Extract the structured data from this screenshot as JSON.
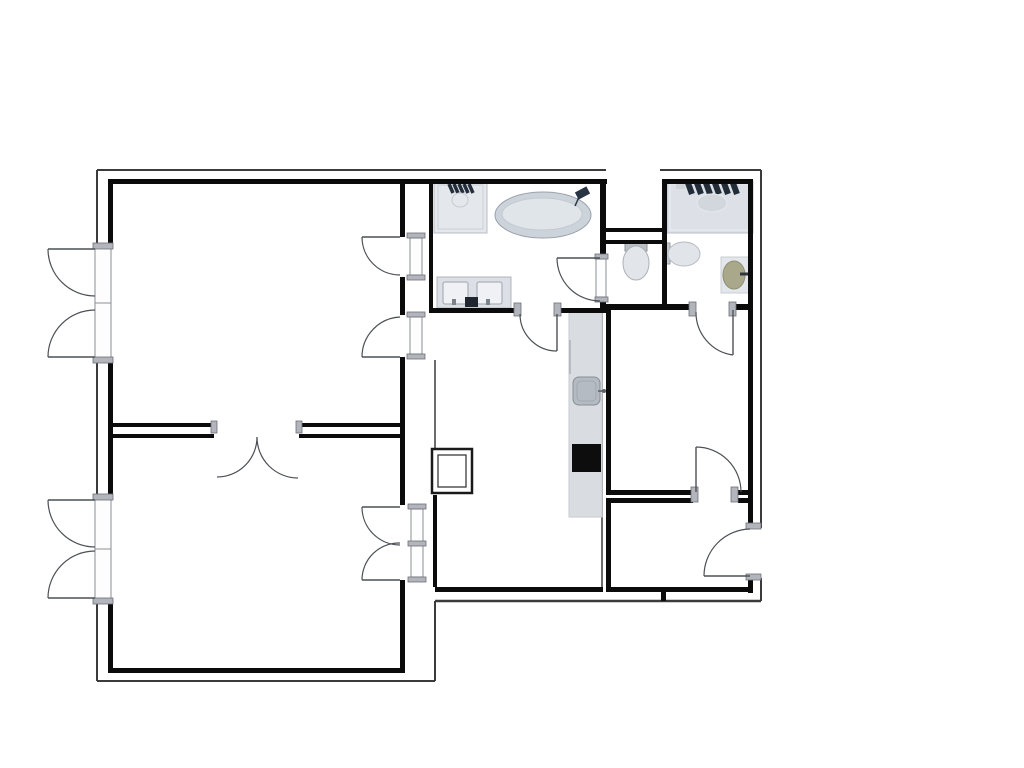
{
  "canvas": {
    "w": 1024,
    "h": 768,
    "bg": "#ffffff"
  },
  "palette": {
    "wall": "#0b0b0b",
    "outline": "#3b3b3c",
    "swing": "#4d5055",
    "cap_fill": "#b2b6bc",
    "cap_stroke": "#6b6f75",
    "frame_fill": "#fdfdfd",
    "frame_stroke": "#8a8f96",
    "fixture_light": "#dde1e7",
    "fixture_mid": "#b5bbc2",
    "fixture_dark": "#222b38",
    "basin_olive": "#aaa88b",
    "cooktop_black": "#0d0d0d"
  },
  "walls_thick": [
    {
      "n": "wall-top-left-room",
      "r": [
        108,
        179,
        297,
        5
      ]
    },
    {
      "n": "wall-top-center",
      "r": [
        404,
        179,
        203,
        5
      ]
    },
    {
      "n": "wall-top-right-room",
      "r": [
        662,
        179,
        91,
        5
      ]
    },
    {
      "n": "wall-left-upper",
      "r": [
        108,
        179,
        5,
        67
      ]
    },
    {
      "n": "wall-left-middle",
      "r": [
        108,
        360,
        5,
        137
      ]
    },
    {
      "n": "wall-left-lower",
      "r": [
        108,
        601,
        5,
        72
      ]
    },
    {
      "n": "wall-rooms-right-1",
      "r": [
        400,
        179,
        5,
        58
      ]
    },
    {
      "n": "wall-rooms-right-2",
      "r": [
        400,
        277,
        5,
        38
      ]
    },
    {
      "n": "wall-rooms-right-3",
      "r": [
        400,
        357,
        5,
        148
      ]
    },
    {
      "n": "wall-rooms-right-4",
      "r": [
        400,
        580,
        5,
        93
      ]
    },
    {
      "n": "wall-divider-top-a",
      "r": [
        108,
        423,
        106,
        4
      ]
    },
    {
      "n": "wall-divider-top-b",
      "r": [
        299,
        423,
        104,
        4
      ]
    },
    {
      "n": "wall-divider-bot-a",
      "r": [
        108,
        434,
        106,
        4
      ]
    },
    {
      "n": "wall-divider-bot-b",
      "r": [
        299,
        434,
        104,
        4
      ]
    },
    {
      "n": "wall-bottom-left-room",
      "r": [
        108,
        668,
        297,
        5
      ]
    },
    {
      "n": "wall-bathroom-left",
      "r": [
        429,
        179,
        4,
        134
      ]
    },
    {
      "n": "wall-bathroom-bottom-a",
      "r": [
        429,
        308,
        90,
        5
      ]
    },
    {
      "n": "wall-bathroom-bottom-b",
      "r": [
        557,
        308,
        50,
        5
      ]
    },
    {
      "n": "wall-bathroom-right-a",
      "r": [
        600,
        179,
        6,
        81
      ]
    },
    {
      "n": "wall-bathroom-right-b",
      "r": [
        600,
        298,
        6,
        15
      ]
    },
    {
      "n": "wall-lightwell-bottom",
      "r": [
        604,
        228,
        60,
        4
      ]
    },
    {
      "n": "wall-wc-top",
      "r": [
        604,
        240,
        60,
        4
      ]
    },
    {
      "n": "wall-wc-right",
      "r": [
        662,
        179,
        5,
        131
      ]
    },
    {
      "n": "wall-bedroom-top-a",
      "r": [
        604,
        304,
        92,
        6
      ]
    },
    {
      "n": "wall-bedroom-top-b",
      "r": [
        732,
        304,
        21,
        6
      ]
    },
    {
      "n": "wall-bedroom-left",
      "r": [
        606,
        310,
        5,
        185
      ]
    },
    {
      "n": "wall-entry-left",
      "r": [
        606,
        503,
        5,
        89
      ]
    },
    {
      "n": "wall-right-upper",
      "r": [
        748,
        179,
        5,
        349
      ]
    },
    {
      "n": "wall-right-lower",
      "r": [
        748,
        578,
        5,
        15
      ]
    },
    {
      "n": "wall-bedroom-bottom-a",
      "r": [
        606,
        490,
        87,
        5
      ]
    },
    {
      "n": "wall-bedroom-bottom-b",
      "r": [
        738,
        490,
        15,
        5
      ]
    },
    {
      "n": "wall-entry-top-a",
      "r": [
        606,
        498,
        87,
        5
      ]
    },
    {
      "n": "wall-entry-top-b",
      "r": [
        738,
        498,
        15,
        5
      ]
    },
    {
      "n": "wall-dining-bottom",
      "r": [
        435,
        587,
        168,
        5
      ]
    },
    {
      "n": "wall-entry-bottom",
      "r": [
        606,
        587,
        147,
        5
      ]
    },
    {
      "n": "wall-stub",
      "r": [
        661,
        592,
        5,
        9
      ]
    },
    {
      "n": "wall-dining-left",
      "r": [
        433,
        495,
        4,
        92
      ]
    }
  ],
  "walls_thin": [
    {
      "n": "outline-top-a",
      "l": [
        97,
        170,
        606,
        170
      ],
      "w": 2
    },
    {
      "n": "outline-top-b",
      "l": [
        660,
        170,
        761,
        170
      ],
      "w": 2
    },
    {
      "n": "outline-right-a",
      "l": [
        761,
        170,
        761,
        528
      ],
      "w": 2
    },
    {
      "n": "outline-right-b",
      "l": [
        761,
        578,
        761,
        601
      ],
      "w": 2
    },
    {
      "n": "outline-bottom-right",
      "l": [
        761,
        601,
        435,
        601
      ],
      "w": 2.5
    },
    {
      "n": "outline-step",
      "l": [
        435,
        601,
        435,
        681
      ],
      "w": 2
    },
    {
      "n": "outline-bottom-left",
      "l": [
        435,
        681,
        97,
        681
      ],
      "w": 2
    },
    {
      "n": "outline-left-a",
      "l": [
        97,
        681,
        97,
        601
      ],
      "w": 2
    },
    {
      "n": "outline-left-b",
      "l": [
        97,
        497,
        97,
        360
      ],
      "w": 2
    },
    {
      "n": "outline-left-c",
      "l": [
        97,
        246,
        97,
        170
      ],
      "w": 2
    },
    {
      "n": "wall-kitchen-right",
      "l": [
        602,
        311,
        602,
        590
      ],
      "w": 1.5
    },
    {
      "n": "wall-dining-offset",
      "l": [
        435,
        360,
        435,
        449
      ],
      "w": 1.5
    }
  ],
  "window_frames": [
    {
      "n": "window-frame-upper",
      "r": [
        95,
        246,
        16,
        114
      ],
      "mull": [
        95,
        303,
        111,
        303
      ]
    },
    {
      "n": "window-frame-lower",
      "r": [
        95,
        497,
        16,
        104
      ],
      "mull": [
        95,
        549,
        111,
        549
      ]
    }
  ],
  "door_frames": [
    {
      "n": "door-frame",
      "r": [
        410,
        238,
        12,
        37
      ]
    },
    {
      "n": "door-frame",
      "r": [
        410,
        317,
        12,
        37
      ]
    },
    {
      "n": "door-frame",
      "r": [
        411,
        509,
        12,
        68
      ]
    },
    {
      "n": "door-frame",
      "r": [
        596,
        259,
        10,
        38
      ]
    }
  ],
  "door_caps": [
    {
      "n": "door-jamb-cap",
      "r": [
        407,
        233,
        18,
        5
      ]
    },
    {
      "n": "door-jamb-cap",
      "r": [
        407,
        275,
        18,
        5
      ]
    },
    {
      "n": "door-jamb-cap",
      "r": [
        407,
        312,
        18,
        5
      ]
    },
    {
      "n": "door-jamb-cap",
      "r": [
        407,
        354,
        18,
        5
      ]
    },
    {
      "n": "door-jamb-cap",
      "r": [
        408,
        504,
        18,
        5
      ]
    },
    {
      "n": "door-jamb-cap",
      "r": [
        408,
        541,
        18,
        5
      ]
    },
    {
      "n": "door-jamb-cap",
      "r": [
        408,
        577,
        18,
        5
      ]
    },
    {
      "n": "door-jamb-cap",
      "r": [
        211,
        421,
        6,
        12
      ]
    },
    {
      "n": "door-jamb-cap",
      "r": [
        296,
        421,
        6,
        12
      ]
    },
    {
      "n": "door-jamb-cap",
      "r": [
        514,
        303,
        7,
        13
      ]
    },
    {
      "n": "door-jamb-cap",
      "r": [
        554,
        303,
        7,
        13
      ]
    },
    {
      "n": "door-jamb-cap",
      "r": [
        595,
        254,
        13,
        5
      ]
    },
    {
      "n": "door-jamb-cap",
      "r": [
        595,
        297,
        13,
        5
      ]
    },
    {
      "n": "door-jamb-cap",
      "r": [
        689,
        302,
        7,
        14
      ]
    },
    {
      "n": "door-jamb-cap",
      "r": [
        729,
        302,
        7,
        14
      ]
    },
    {
      "n": "door-jamb-cap",
      "r": [
        691,
        487,
        7,
        15
      ]
    },
    {
      "n": "door-jamb-cap",
      "r": [
        731,
        487,
        7,
        15
      ]
    },
    {
      "n": "door-jamb-cap",
      "r": [
        746,
        523,
        15,
        6
      ]
    },
    {
      "n": "door-jamb-cap",
      "r": [
        746,
        574,
        15,
        6
      ]
    },
    {
      "n": "window-jamb-cap",
      "r": [
        93,
        243,
        20,
        6
      ]
    },
    {
      "n": "window-jamb-cap",
      "r": [
        93,
        357,
        20,
        6
      ]
    },
    {
      "n": "window-jamb-cap",
      "r": [
        93,
        494,
        20,
        6
      ]
    },
    {
      "n": "window-jamb-cap",
      "r": [
        93,
        598,
        20,
        6
      ]
    }
  ],
  "door_leaves": [
    {
      "n": "door-leaf",
      "l": [
        362,
        237,
        400,
        237
      ]
    },
    {
      "n": "door-leaf",
      "l": [
        362,
        357,
        400,
        357
      ]
    },
    {
      "n": "door-leaf",
      "l": [
        362,
        507,
        400,
        507
      ]
    },
    {
      "n": "door-leaf",
      "l": [
        362,
        580,
        400,
        580
      ]
    },
    {
      "n": "window-casement-leaf",
      "l": [
        48,
        249,
        95,
        249
      ]
    },
    {
      "n": "window-casement-leaf",
      "l": [
        48,
        357,
        95,
        357
      ]
    },
    {
      "n": "window-casement-leaf",
      "l": [
        48,
        500,
        95,
        500
      ]
    },
    {
      "n": "window-casement-leaf",
      "l": [
        48,
        598,
        95,
        598
      ]
    },
    {
      "n": "door-leaf",
      "l": [
        557,
        314,
        557,
        351
      ]
    },
    {
      "n": "door-leaf",
      "l": [
        557,
        258,
        600,
        258
      ]
    },
    {
      "n": "door-leaf",
      "l": [
        733,
        310,
        733,
        355
      ]
    },
    {
      "n": "door-leaf",
      "l": [
        696,
        447,
        696,
        492
      ]
    },
    {
      "n": "door-leaf",
      "l": [
        704,
        576,
        750,
        576
      ]
    }
  ],
  "swing_arcs": [
    {
      "n": "door-swing-arc",
      "d": "M 362 237 A 38 38 0 0 0 400 275"
    },
    {
      "n": "door-swing-arc",
      "d": "M 362 357 A 40 40 0 0 1 400 317"
    },
    {
      "n": "door-swing-arc",
      "d": "M 362 507 A 38 38 0 0 0 400 545"
    },
    {
      "n": "door-swing-arc",
      "d": "M 362 580 A 37 37 0 0 1 400 543"
    },
    {
      "n": "door-swing-arc",
      "d": "M 257 437 A 40 40 0 0 1 217 477"
    },
    {
      "n": "door-swing-arc",
      "d": "M 257 437 A 41 41 0 0 0 298 478"
    },
    {
      "n": "window-swing-arc",
      "d": "M 48 249 A 47 47 0 0 0 95 296"
    },
    {
      "n": "window-swing-arc",
      "d": "M 48 357 A 47 47 0 0 1 95 310"
    },
    {
      "n": "window-swing-arc",
      "d": "M 48 500 A 47 47 0 0 0 95 547"
    },
    {
      "n": "window-swing-arc",
      "d": "M 48 598 A 47 47 0 0 1 95 551"
    },
    {
      "n": "door-swing-arc",
      "d": "M 520 314 A 37 37 0 0 0 557 351"
    },
    {
      "n": "door-swing-arc",
      "d": "M 557 258 A 43 43 0 0 0 600 301"
    },
    {
      "n": "door-swing-arc",
      "d": "M 696 312 A 43 43 0 0 0 733 355"
    },
    {
      "n": "door-swing-arc",
      "d": "M 696 447 A 45 45 0 0 1 741 492"
    },
    {
      "n": "door-swing-arc",
      "d": "M 704 576 A 47 47 0 0 1 750 529"
    }
  ],
  "fixtures": [
    {
      "n": "shower-tray",
      "t": "rect",
      "x": 434,
      "y": 181,
      "w": 53,
      "h": 52,
      "f": "#e4e7eb",
      "s": "#b9bdc3"
    },
    {
      "n": "shower-tray-inner",
      "t": "rect",
      "x": 438,
      "y": 185,
      "w": 45,
      "h": 44,
      "f": "none",
      "s": "#cdd1d7"
    },
    {
      "n": "shower-fittings",
      "t": "slashes",
      "x": 449,
      "y": 184,
      "n2": 5,
      "dx": 5,
      "len": 9,
      "s": "#242d3b",
      "w": 3.5
    },
    {
      "n": "shower-head",
      "t": "ellipse",
      "cx": 460,
      "cy": 200,
      "rx": 8,
      "ry": 7,
      "f": "none",
      "s": "#c6cad0"
    },
    {
      "n": "bathtub-outer",
      "t": "ellipse",
      "cx": 543,
      "cy": 215,
      "rx": 48,
      "ry": 23,
      "f": "#cdd3da",
      "s": "#9aa2aa"
    },
    {
      "n": "bathtub-inner",
      "t": "ellipse",
      "cx": 542,
      "cy": 214,
      "rx": 40,
      "ry": 16,
      "f": "#e0e5ea",
      "s": "#c3c9d0"
    },
    {
      "n": "bathtub-faucet",
      "t": "rect",
      "x": 576,
      "y": 189,
      "w": 13,
      "h": 8,
      "f": "#2a3544",
      "s": "none",
      "rot": -28
    },
    {
      "n": "bathtub-faucet-stem",
      "t": "line",
      "x1": 579,
      "y1": 197,
      "x2": 575,
      "y2": 206,
      "s": "#2a3544",
      "w": 1.5
    },
    {
      "n": "vanity-counter",
      "t": "rect",
      "x": 437,
      "y": 277,
      "w": 74,
      "h": 31,
      "f": "#dce0e6",
      "s": "#b0b5bb"
    },
    {
      "n": "vanity-sink-left",
      "t": "rect",
      "x": 443,
      "y": 282,
      "w": 25,
      "h": 22,
      "rx": 2,
      "f": "#eff1f4",
      "s": "#9ea4ac"
    },
    {
      "n": "vanity-sink-right",
      "t": "rect",
      "x": 477,
      "y": 282,
      "w": 25,
      "h": 22,
      "rx": 2,
      "f": "#eff1f4",
      "s": "#9ea4ac"
    },
    {
      "n": "vanity-faucet-left",
      "t": "rect",
      "x": 452,
      "y": 299,
      "w": 4,
      "h": 6,
      "f": "#7b828b",
      "s": "none"
    },
    {
      "n": "vanity-faucet-right",
      "t": "rect",
      "x": 486,
      "y": 299,
      "w": 4,
      "h": 6,
      "f": "#7b828b",
      "s": "none"
    },
    {
      "n": "vanity-accessory",
      "t": "rect",
      "x": 465,
      "y": 297,
      "w": 13,
      "h": 10,
      "f": "#20262f",
      "s": "none"
    },
    {
      "n": "wc-toilet-cistern",
      "t": "rect",
      "x": 625,
      "y": 243,
      "w": 22,
      "h": 8,
      "f": "#b9bec5",
      "s": "#8d939a"
    },
    {
      "n": "wc-toilet-bowl",
      "t": "ellipse",
      "cx": 636,
      "cy": 263,
      "rx": 13,
      "ry": 17,
      "f": "#e2e5e9",
      "s": "#abb1b8"
    },
    {
      "n": "bathroom2-counter",
      "t": "rect",
      "x": 667,
      "y": 181,
      "w": 86,
      "h": 52,
      "f": "#dde1e7",
      "s": "#b8bdc4"
    },
    {
      "n": "bathroom2-counter-inner",
      "t": "rect",
      "x": 670,
      "y": 184,
      "w": 80,
      "h": 46,
      "f": "none",
      "s": "#eceef1"
    },
    {
      "n": "bathroom2-towels",
      "t": "slashes",
      "x": 688,
      "y": 183,
      "n2": 6,
      "dx": 9,
      "len": 11,
      "s": "#222b38",
      "w": 6
    },
    {
      "n": "bathroom2-sink",
      "t": "ellipse",
      "cx": 712,
      "cy": 203,
      "rx": 15,
      "ry": 9,
      "f": "#d2d7de",
      "s": "#e6e9ed"
    },
    {
      "n": "bathroom2-tray",
      "t": "rect",
      "x": 676,
      "y": 184,
      "w": 9,
      "h": 5,
      "f": "#ced3da",
      "s": "none"
    },
    {
      "n": "bathroom2-toilet-tank",
      "t": "rect",
      "x": 663,
      "y": 243,
      "w": 7,
      "h": 21,
      "f": "#c3c8ce",
      "s": "#989ea6"
    },
    {
      "n": "bathroom2-toilet-bowl",
      "t": "ellipse",
      "cx": 684,
      "cy": 254,
      "rx": 16,
      "ry": 12,
      "f": "#e1e4e8",
      "s": "#b5bbc2"
    },
    {
      "n": "basin-stand",
      "t": "rect",
      "x": 721,
      "y": 257,
      "w": 31,
      "h": 36,
      "f": "#e3e6ea",
      "s": "#c8ccd2"
    },
    {
      "n": "round-basin",
      "t": "ellipse",
      "cx": 734,
      "cy": 275,
      "rx": 11,
      "ry": 14,
      "f": "#aaa88b",
      "s": "#908e74"
    },
    {
      "n": "basin-faucet",
      "t": "line",
      "x1": 740,
      "y1": 274,
      "x2": 748,
      "y2": 274,
      "s": "#30363e",
      "w": 3
    },
    {
      "n": "kitchen-counter",
      "t": "rect",
      "x": 569,
      "y": 311,
      "w": 33,
      "h": 206,
      "f": "#d9dde2",
      "s": "#c6cad0"
    },
    {
      "n": "kitchen-counter-edge",
      "t": "line",
      "x1": 570,
      "y1": 340,
      "x2": 570,
      "y2": 374,
      "s": "#aeb3b9",
      "w": 1.5
    },
    {
      "n": "kitchen-sink",
      "t": "rect",
      "x": 573,
      "y": 377,
      "w": 27,
      "h": 28,
      "rx": 6,
      "f": "#b5bbc2",
      "s": "#888e96"
    },
    {
      "n": "kitchen-sink-inner",
      "t": "rect",
      "x": 577,
      "y": 381,
      "w": 19,
      "h": 20,
      "rx": 4,
      "f": "none",
      "s": "#a3a9b0"
    },
    {
      "n": "kitchen-faucet",
      "t": "line",
      "x1": 598,
      "y1": 391,
      "x2": 605,
      "y2": 391,
      "s": "#6a7078",
      "w": 2
    },
    {
      "n": "kitchen-faucet-knob",
      "t": "ellipse",
      "cx": 604,
      "cy": 391,
      "rx": 2,
      "ry": 2,
      "f": "#5b6169",
      "s": "none"
    },
    {
      "n": "cooktop",
      "t": "rect",
      "x": 572,
      "y": 444,
      "w": 29,
      "h": 28,
      "f": "#0d0d0d",
      "s": "none"
    },
    {
      "n": "column-shaft-outer",
      "t": "rect",
      "x": 432,
      "y": 449,
      "w": 40,
      "h": 44,
      "f": "#ffffff",
      "s": "#1a1a1a",
      "sw": 2.5
    },
    {
      "n": "column-shaft-inner",
      "t": "rect",
      "x": 438,
      "y": 455,
      "w": 28,
      "h": 32,
      "f": "none",
      "s": "#3a3a3a",
      "sw": 1.3
    }
  ]
}
